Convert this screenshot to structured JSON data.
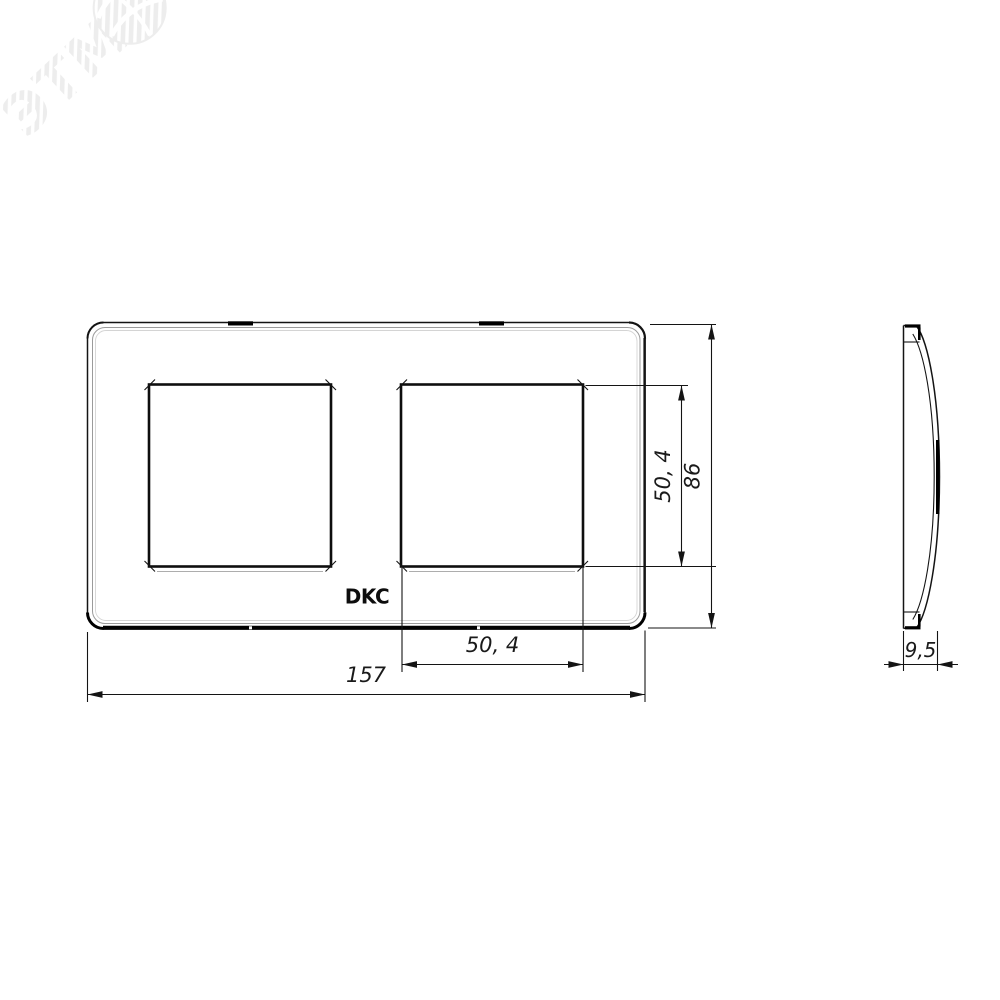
{
  "colors": {
    "background": "#ffffff",
    "line": "#141414",
    "secondary_line": "#9b9b9b",
    "tertiary_line": "#d4d4d4",
    "watermark": "#ededed"
  },
  "watermark": {
    "text": "ЭТМ",
    "icon": "globe-icon"
  },
  "front_view": {
    "logo": "DKC",
    "dimensions": {
      "opening_height": "50, 4",
      "overall_height": "86",
      "opening_width": "50, 4",
      "overall_width": "157"
    }
  },
  "side_view": {
    "dimensions": {
      "thickness": "9,5"
    }
  }
}
